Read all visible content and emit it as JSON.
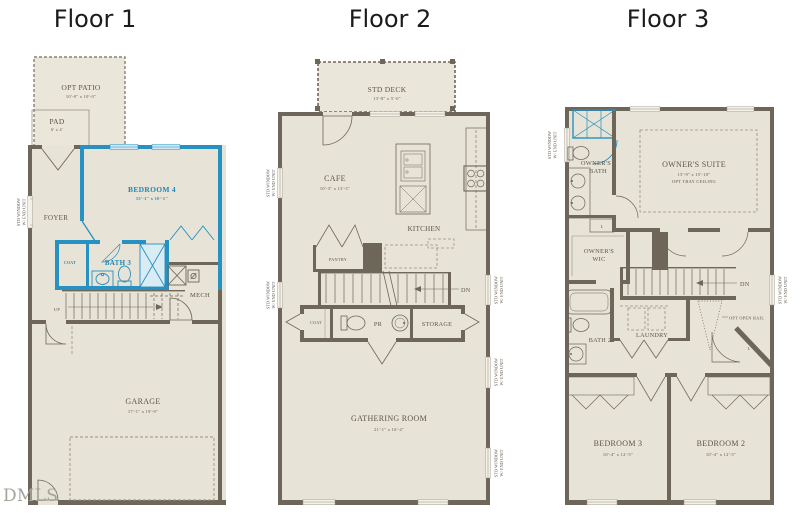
{
  "page": {
    "watermark": "DMLS"
  },
  "window_note": {
    "line1": "STD WINDOW",
    "line2": "W/ END UNIT"
  },
  "colors": {
    "wall": "#6F665A",
    "floor_fill": "#E7E3D6",
    "highlight_blue": "#2791C1",
    "label_text": "#5E5549",
    "blue_label": "#1F86B4"
  },
  "floor1": {
    "title": "Floor 1",
    "opt_patio": {
      "label": "OPT PATIO",
      "dims": "10'-0\" x 10'-0\""
    },
    "pad": {
      "label": "PAD",
      "dims": "6' x 4'"
    },
    "bedroom4": {
      "label": "BEDROOM 4",
      "dims": "15'-1\" x 10'-1\""
    },
    "foyer": {
      "label": "FOYER"
    },
    "coat": {
      "label": "COAT"
    },
    "bath3": {
      "label": "BATH 3"
    },
    "mech": {
      "label": "MECH"
    },
    "stairs": {
      "label": "UP"
    },
    "garage": {
      "label": "GARAGE",
      "dims": "17'-1\" x 19'-9\""
    }
  },
  "floor2": {
    "title": "Floor 2",
    "std_deck": {
      "label": "STD DECK",
      "dims": "13'-8\" x 5'-0\""
    },
    "cafe": {
      "label": "CAFE",
      "dims": "10'-3\" x 13'-5\""
    },
    "kitchen": {
      "label": "KITCHEN"
    },
    "pantry": {
      "label": "PANTRY"
    },
    "stairs": {
      "label": "DN"
    },
    "coat": {
      "label": "COAT"
    },
    "powder_room": {
      "label": "PR"
    },
    "storage": {
      "label": "STORAGE"
    },
    "gathering_room": {
      "label": "GATHERING ROOM",
      "dims": "21'-1\" x 16'-4\""
    }
  },
  "floor3": {
    "title": "Floor 3",
    "owners_bath": {
      "line1": "OWNER'S",
      "line2": "BATH"
    },
    "owners_suite": {
      "label": "OWNER'S SUITE",
      "dims": "15'-9\" x 15'-10\"",
      "option": "OPT TRAY CEILING"
    },
    "owners_wic": {
      "line1": "OWNER'S",
      "line2": "WIC"
    },
    "stairs": {
      "label": "DN"
    },
    "opt_open_rail": {
      "label": "OPT OPEN RAIL"
    },
    "bath2": {
      "label": "BATH 2"
    },
    "laundry": {
      "label": "LAUNDRY"
    },
    "linen_upper": {
      "label": "L"
    },
    "linen_lower": {
      "label": "L"
    },
    "bedroom3": {
      "label": "BEDROOM 3",
      "dims": "10'-4\" x 12'-5\""
    },
    "bedroom2": {
      "label": "BEDROOM 2",
      "dims": "10'-4\" x 12'-5\""
    }
  }
}
